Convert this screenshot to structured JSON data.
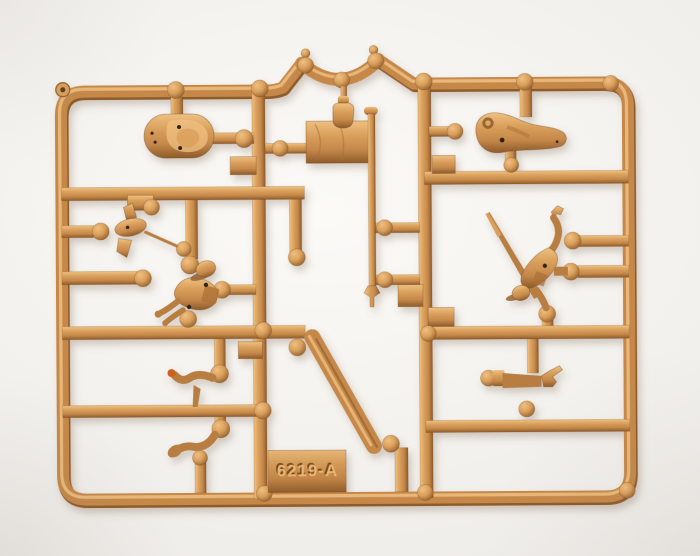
{
  "photo": {
    "type": "photograph",
    "subject": "tan plastic injection-molded model sprue with miniature toy-soldier parts",
    "mold_code": "6219-A"
  },
  "colors": {
    "background_center": "#fbfaf7",
    "background_mid": "#f0eeea",
    "background_edge": "#e6e3df",
    "plastic_light": "#efc081",
    "plastic_mid": "#d99f5b",
    "plastic_base": "#c5884a",
    "plastic_dark": "#8e5b2a",
    "figure_base": "#b87d3f",
    "emboss_dark": "#7c4e1e",
    "emboss_light": "#eab878",
    "paint_tip": "#cf5f1d"
  },
  "parts": {
    "frame": "outer sprue frame",
    "arch": "curved saddle part in top rail",
    "oval_base": "oval figure base",
    "terrain_base": "irregular terrain base",
    "flag": "flag on pole",
    "flagpole": "flag pole with pommel",
    "canteen": "small canteen part",
    "figure_small": "small crawling figure part",
    "figure_soldier": "helmeted soldier figure",
    "figure_lancer": "figure with raised lance",
    "arm_upper_left": "bent arm part",
    "arm_lower_left": "arm with hand part",
    "arm_pointing": "pointing arm part",
    "strip": "diagonal strap part",
    "code_tab": "embossed mold-code tab"
  }
}
